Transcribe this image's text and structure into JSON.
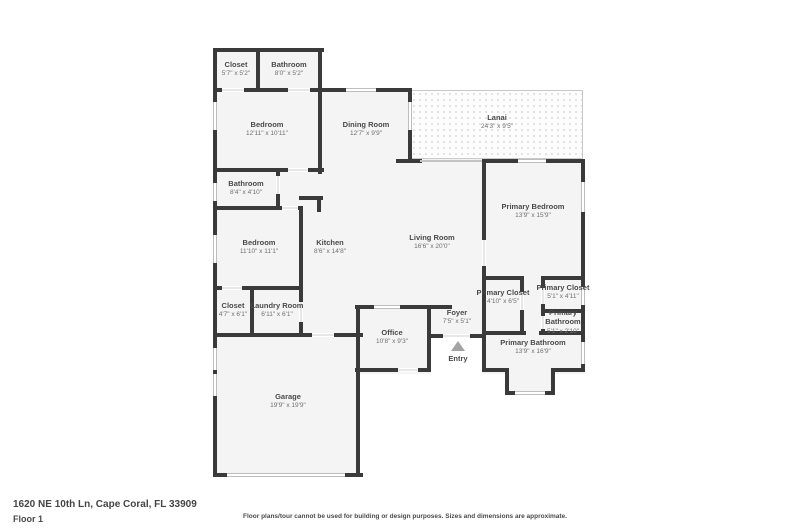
{
  "rooms": [
    {
      "name": "Closet",
      "dims": "5'7\" x 5'2\""
    },
    {
      "name": "Bathroom",
      "dims": "8'0\" x 5'2\""
    },
    {
      "name": "Bedroom",
      "dims": "12'11\" x 10'11\""
    },
    {
      "name": "Dining Room",
      "dims": "12'7\" x 9'9\""
    },
    {
      "name": "Lanai",
      "dims": "24'3\" x 9'5\""
    },
    {
      "name": "Bathroom",
      "dims": "8'4\" x 4'10\""
    },
    {
      "name": "Bedroom",
      "dims": "11'10\" x 11'1\""
    },
    {
      "name": "Kitchen",
      "dims": "8'6\" x 14'8\""
    },
    {
      "name": "Living Room",
      "dims": "16'6\" x 20'0\""
    },
    {
      "name": "Primary Bedroom",
      "dims": "13'9\" x 15'9\""
    },
    {
      "name": "Closet",
      "dims": "4'7\" x 6'1\""
    },
    {
      "name": "Laundry Room",
      "dims": "6'11\" x 6'1\""
    },
    {
      "name": "Primary Closet",
      "dims": "4'10\" x 6'5\""
    },
    {
      "name": "Primary Closet",
      "dims": "5'1\" x 4'11\""
    },
    {
      "name": "Primary Bathroom",
      "dims": "5'1\" x 2'10\""
    },
    {
      "name": "Office",
      "dims": "10'8\" x 9'3\""
    },
    {
      "name": "Foyer",
      "dims": "7'5\" x 5'1\""
    },
    {
      "name": "Primary Bathroom",
      "dims": "13'9\" x 16'9\""
    },
    {
      "name": "Garage",
      "dims": "19'9\" x 19'9\""
    },
    {
      "name": "Entry",
      "dims": ""
    }
  ],
  "footer": {
    "address": "1620 NE 10th Ln, Cape Coral, FL 33909",
    "floor_label": "Floor 1",
    "disclaimer": "Floor plans/tour cannot be used for building or design purposes. Sizes and dimensions are approximate."
  },
  "colors": {
    "wall": "#3a3a3a",
    "room_fill": "#f4f4f4",
    "lanai_dot": "#e3e3e3",
    "text_primary": "#4a4a4a",
    "text_secondary": "#6f6f6f",
    "entry_arrow": "#a3a3a3"
  }
}
